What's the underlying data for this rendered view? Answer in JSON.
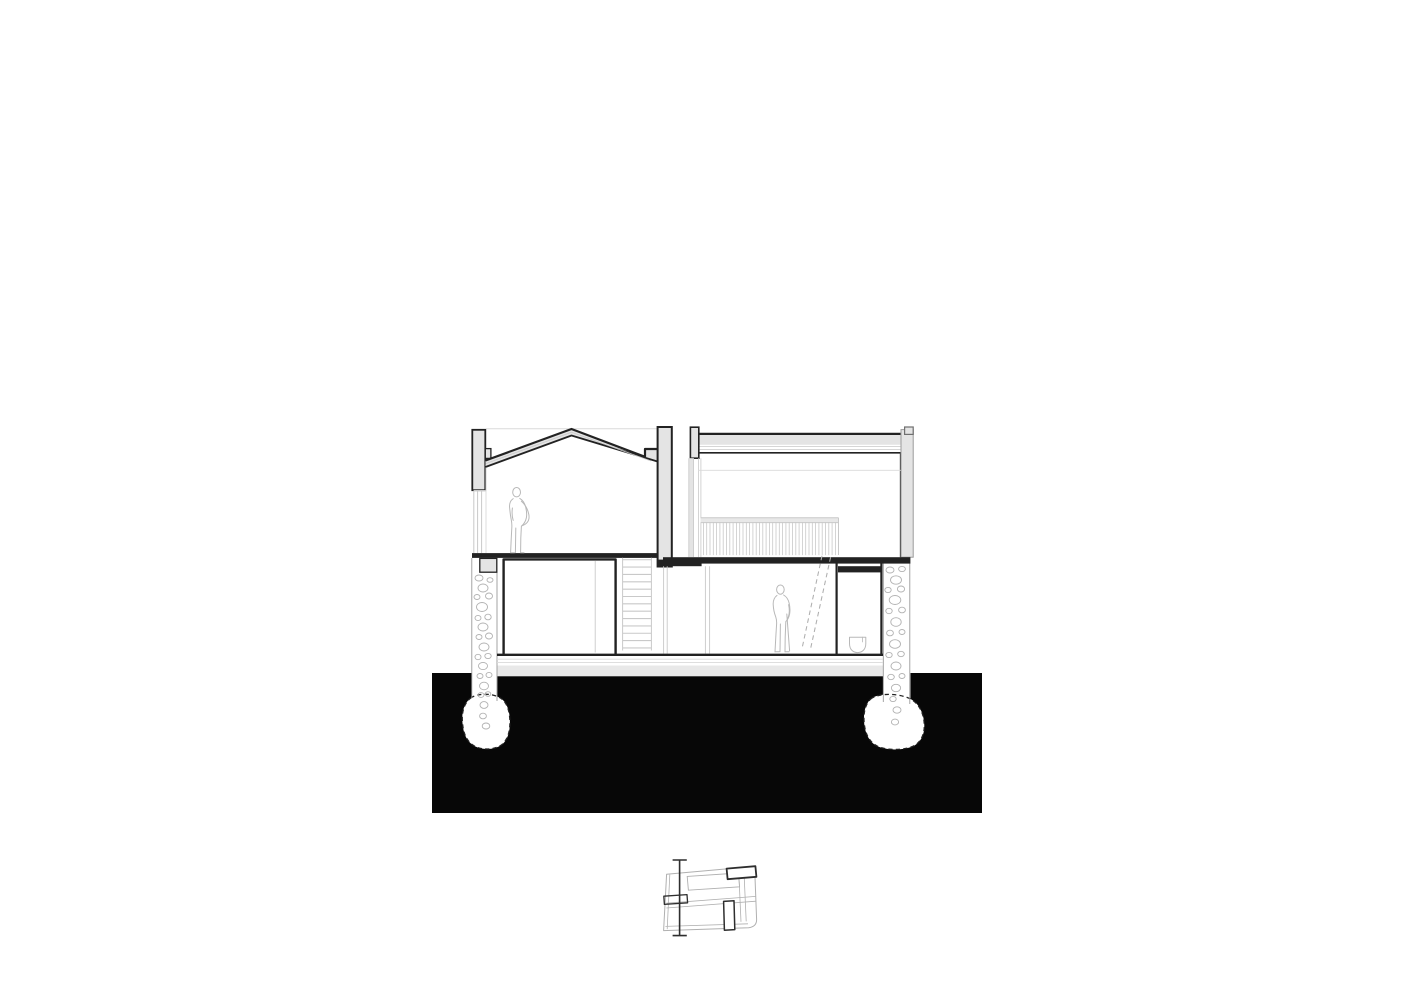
{
  "page": {
    "background": "#ffffff"
  },
  "colors": {
    "line-dark": "#222222",
    "line-mid": "#9a9a9a",
    "line-light": "#c9c9c9",
    "line-faint": "#dadada",
    "wall-fill": "#e4e4e4",
    "slab-fill": "#e8e8e8",
    "ground-black": "#070707",
    "stone-line": "#b2b2b2",
    "figure-line": "#b8b8b8",
    "hidden-dash": "#aeaeae",
    "plan-bold": "#2e2e2e",
    "plan-light": "#b0b0b0",
    "paper": "#ffffff"
  },
  "drawing": {
    "label": "architectural cross-section drawing",
    "human_figures": 2,
    "stair_treads": 13,
    "railing_balusters": 41,
    "stone_wall_columns": 2,
    "foundation_pads": 2,
    "text_annotations": "none"
  },
  "key_plan": {
    "label": "key plan with vertical section cut line",
    "section_ticks": 2
  }
}
